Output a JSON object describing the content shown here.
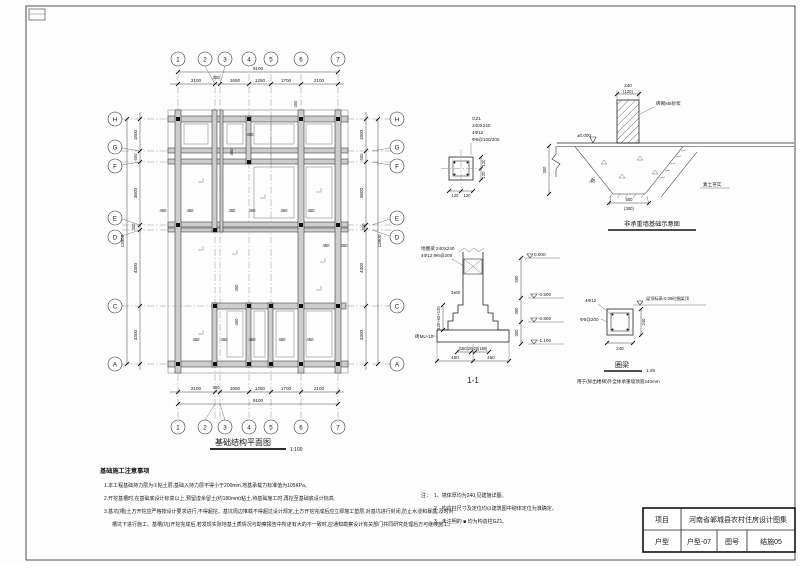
{
  "titleblock": {
    "label_project": "项目",
    "project": "河南省郸城县农村住房设计图集",
    "label_model": "户型",
    "model": "户型-07",
    "label_no": "图号",
    "no": "结施05"
  },
  "plan": {
    "title": "基础结构平面图",
    "scale": "1:100",
    "grid_cols": [
      "1",
      "2",
      "3",
      "4",
      "5",
      "6",
      "7"
    ],
    "grid_rows": [
      "H",
      "G",
      "F",
      "E",
      "D",
      "C",
      "A"
    ],
    "dims_top": [
      "2100",
      "300",
      "1650",
      "1250",
      "1700",
      "2100"
    ],
    "dims_left": [
      "1800",
      "600",
      "3600",
      "300",
      "4300",
      "3300"
    ],
    "total_w": "9100",
    "total_h": "13900",
    "dim450": "450"
  },
  "gz1": {
    "name": "GZ1",
    "size": "240X240",
    "rebar": "4Φ12",
    "stirrup": "Φ6@100/200",
    "d120": "120"
  },
  "nb": {
    "d240": "240",
    "d120": "(120)",
    "masonry": "砖砌M5砂浆",
    "level": "±0.000",
    "d300": "300",
    "soil": "素土夯实",
    "angle": "45°",
    "d500": "500",
    "d300b": "(300)",
    "title": "非承重墙基础示意图"
  },
  "s11": {
    "beam_l1": "地圈梁 240X240",
    "beam_l2": "4Φ12;Φ6@200",
    "steps": "3x60",
    "step_dim": "120+60+120",
    "brick": "砖MU-10",
    "lv0": "0.000",
    "lv1": "-0.500",
    "lv2": "-0.800",
    "lv3": "-1.100",
    "d500": "500",
    "d300": "300",
    "dims_a": "|180|20|20|180|",
    "d450": "450",
    "title": "1-1"
  },
  "ring": {
    "rebar": "4Φ12",
    "stirrup": "Φ6@200",
    "level_note": "梁顶标高-0.05砼圈梁顶",
    "d240": "240",
    "title": "圈梁",
    "scale": "1:25",
    "note": "用于(除出楼梯)外全体承重墙顶宽240mm"
  },
  "notes": {
    "title": "基础施工注意事项",
    "n1": "1.本工程基础持力层为①粘土层,基础入持力层不得小于200mm,地基承载力标准值为105KPa。",
    "n2": "2.开挖基槽时,在基础底设计标高以上,预留虚余留土(约180mm)粘土,待基础施工时,再挖至基础底设计标高.",
    "n3a": "3.基坑(槽)土方开挖应严格按设计要求进行,不得超挖。基坑周边堆载不得超过设计规定,土方开挖完成后应立即施工垫层,对基坑进行封闭,防止水浸和暴露,及时对",
    "n3b": "槽坑下进行施工。基槽(坑)开挖完成后,若发现实际地基土质情况与勘察报告中所述有大的不一致时,应通知勘察设计有关部门共同研究处理后方可继续施工。"
  },
  "rnotes": {
    "prefix": "注：",
    "n1": "1、墙体厚均为240,见建施详图。",
    "n2": "2、构造柱尺寸及定位均以建筑图中砌体定位为准确定。",
    "n3": "3、未注明的 ■ 均为构造柱GZ1。"
  }
}
